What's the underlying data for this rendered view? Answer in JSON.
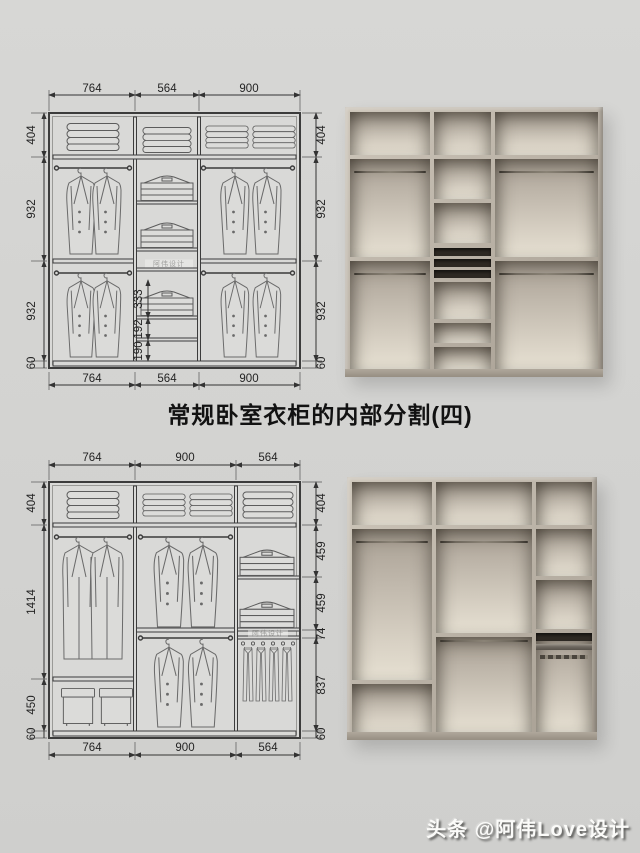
{
  "title": "常规卧室衣柜的内部分割(四)",
  "credit_watermark": "头条 @阿伟Love设计",
  "embedded_watermark": "阿伟设计",
  "drawing_top": {
    "widths_top": [
      "764",
      "564",
      "900"
    ],
    "widths_bottom": [
      "764",
      "564",
      "900"
    ],
    "heights_left": [
      "404",
      "932",
      "932"
    ],
    "base_left": "60",
    "heights_right": [
      "404",
      "932",
      "932"
    ],
    "base_right": "60",
    "middle_shelf_dims": [
      "333",
      "192",
      "190"
    ]
  },
  "drawing_bottom": {
    "widths_top": [
      "764",
      "900",
      "564"
    ],
    "widths_bottom": [
      "764",
      "900",
      "564"
    ],
    "heights_left": [
      "404",
      "1414",
      "450"
    ],
    "base_left": "60",
    "heights_right": [
      "404",
      "459",
      "459",
      "74",
      "837"
    ],
    "base_right": "60"
  },
  "colors": {
    "background": "#d3d3d1",
    "carcass_wood": "#b6aea2",
    "interior_cream": "#e4decf",
    "drawer_slot": "#2e2923",
    "line": "#3c3c3c"
  }
}
